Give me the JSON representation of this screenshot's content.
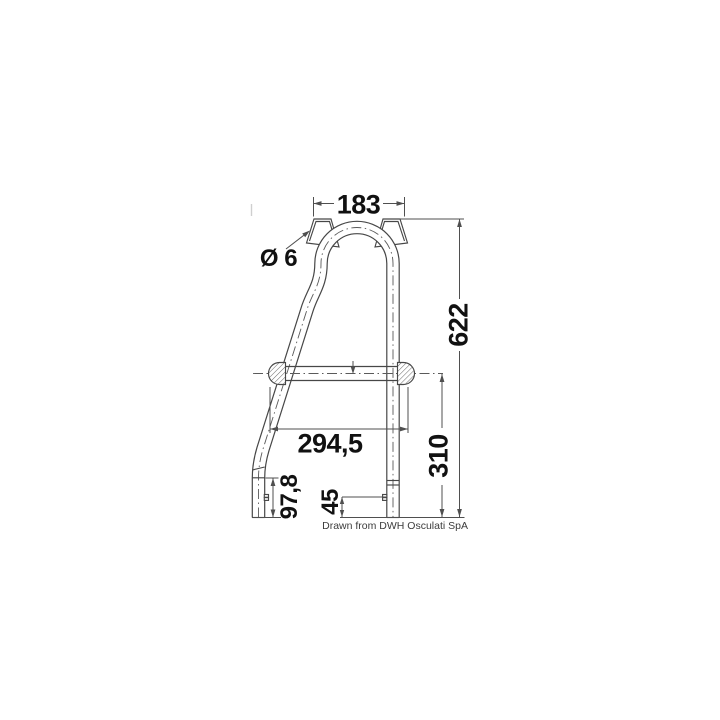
{
  "page": {
    "background": "#ffffff"
  },
  "drawing": {
    "line_color": "#474747",
    "dim_text_color": "#111111",
    "dimensions": {
      "top_width": "183",
      "hole_diameter": "Ø 6",
      "total_height": "622",
      "rung_span": "294,5",
      "rung_to_bottom": "310",
      "left_leg_lower": "97,8",
      "clamp_to_bottom": "45"
    },
    "credit": "Drawn from DWH Osculati SpA"
  }
}
